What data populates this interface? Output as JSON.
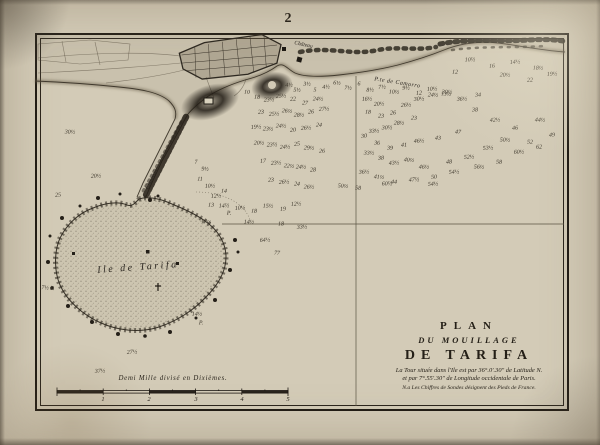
{
  "page": {
    "number": "2"
  },
  "map": {
    "island_label": "Ile de Tarifa",
    "point_label": "P.te de Camorro",
    "chateau_label": "Château",
    "causeway_label": "Chaussée",
    "title_block": {
      "line1": "PLAN",
      "line2": "DU MOUILLAGE",
      "line3": "DE TARIFA",
      "note1": "La Tour située dans l'Ile est par 36°.0′.30″ de Latitude N.",
      "note2": "et par 7°.55′.30″ de Longitude occidentale de Paris.",
      "note3": "N.a Les Chiffres de Sondes désignent des Pieds de France."
    },
    "scale": {
      "label": "Demi Mille divisé en Dixièmes.",
      "ticks": [
        "1",
        "2",
        "3",
        "4",
        "5"
      ]
    },
    "soundings": [
      {
        "x": 289,
        "y": 85,
        "v": "4½"
      },
      {
        "x": 297,
        "y": 90,
        "v": "5½"
      },
      {
        "x": 307,
        "y": 84,
        "v": "3½"
      },
      {
        "x": 315,
        "y": 90,
        "v": "5"
      },
      {
        "x": 326,
        "y": 87,
        "v": "4½"
      },
      {
        "x": 337,
        "y": 83,
        "v": "6½"
      },
      {
        "x": 348,
        "y": 88,
        "v": "7½"
      },
      {
        "x": 359,
        "y": 84,
        "v": "6"
      },
      {
        "x": 370,
        "y": 90,
        "v": "8½"
      },
      {
        "x": 382,
        "y": 87,
        "v": "7½"
      },
      {
        "x": 394,
        "y": 92,
        "v": "10½"
      },
      {
        "x": 406,
        "y": 88,
        "v": "9½"
      },
      {
        "x": 419,
        "y": 93,
        "v": "12"
      },
      {
        "x": 432,
        "y": 89,
        "v": "10½"
      },
      {
        "x": 446,
        "y": 94,
        "v": "13½"
      },
      {
        "x": 455,
        "y": 72,
        "v": "12"
      },
      {
        "x": 470,
        "y": 60,
        "v": "10½"
      },
      {
        "x": 492,
        "y": 66,
        "v": "16"
      },
      {
        "x": 515,
        "y": 62,
        "v": "14½"
      },
      {
        "x": 538,
        "y": 68,
        "v": "18½"
      },
      {
        "x": 505,
        "y": 75,
        "v": "20½"
      },
      {
        "x": 530,
        "y": 80,
        "v": "22"
      },
      {
        "x": 552,
        "y": 74,
        "v": "19½"
      },
      {
        "x": 247,
        "y": 92,
        "v": "10"
      },
      {
        "x": 257,
        "y": 97,
        "v": "18"
      },
      {
        "x": 269,
        "y": 100,
        "v": "23½"
      },
      {
        "x": 281,
        "y": 96,
        "v": "25½"
      },
      {
        "x": 293,
        "y": 99,
        "v": "22"
      },
      {
        "x": 305,
        "y": 103,
        "v": "27"
      },
      {
        "x": 318,
        "y": 99,
        "v": "24½"
      },
      {
        "x": 261,
        "y": 112,
        "v": "23"
      },
      {
        "x": 274,
        "y": 114,
        "v": "25½"
      },
      {
        "x": 287,
        "y": 111,
        "v": "26½"
      },
      {
        "x": 299,
        "y": 115,
        "v": "28½"
      },
      {
        "x": 311,
        "y": 112,
        "v": "26"
      },
      {
        "x": 324,
        "y": 109,
        "v": "27½"
      },
      {
        "x": 256,
        "y": 127,
        "v": "19½"
      },
      {
        "x": 268,
        "y": 129,
        "v": "23½"
      },
      {
        "x": 281,
        "y": 126,
        "v": "24½"
      },
      {
        "x": 293,
        "y": 130,
        "v": "20"
      },
      {
        "x": 306,
        "y": 128,
        "v": "26½"
      },
      {
        "x": 319,
        "y": 125,
        "v": "24"
      },
      {
        "x": 259,
        "y": 143,
        "v": "20½"
      },
      {
        "x": 272,
        "y": 145,
        "v": "23½"
      },
      {
        "x": 285,
        "y": 147,
        "v": "24½"
      },
      {
        "x": 297,
        "y": 144,
        "v": "25"
      },
      {
        "x": 309,
        "y": 148,
        "v": "29½"
      },
      {
        "x": 322,
        "y": 151,
        "v": "26"
      },
      {
        "x": 263,
        "y": 161,
        "v": "17"
      },
      {
        "x": 276,
        "y": 163,
        "v": "23½"
      },
      {
        "x": 289,
        "y": 166,
        "v": "22½"
      },
      {
        "x": 301,
        "y": 167,
        "v": "24½"
      },
      {
        "x": 313,
        "y": 170,
        "v": "28"
      },
      {
        "x": 271,
        "y": 180,
        "v": "23"
      },
      {
        "x": 284,
        "y": 182,
        "v": "26½"
      },
      {
        "x": 297,
        "y": 184,
        "v": "24"
      },
      {
        "x": 309,
        "y": 187,
        "v": "26½"
      },
      {
        "x": 367,
        "y": 99,
        "v": "16½"
      },
      {
        "x": 379,
        "y": 104,
        "v": "20½"
      },
      {
        "x": 368,
        "y": 112,
        "v": "18"
      },
      {
        "x": 381,
        "y": 116,
        "v": "23"
      },
      {
        "x": 393,
        "y": 113,
        "v": "26"
      },
      {
        "x": 406,
        "y": 105,
        "v": "26½"
      },
      {
        "x": 419,
        "y": 99,
        "v": "30½"
      },
      {
        "x": 433,
        "y": 95,
        "v": "24½"
      },
      {
        "x": 447,
        "y": 92,
        "v": "30½"
      },
      {
        "x": 462,
        "y": 99,
        "v": "36½"
      },
      {
        "x": 478,
        "y": 95,
        "v": "34"
      },
      {
        "x": 414,
        "y": 118,
        "v": "23"
      },
      {
        "x": 399,
        "y": 123,
        "v": "28½"
      },
      {
        "x": 387,
        "y": 128,
        "v": "30½"
      },
      {
        "x": 374,
        "y": 131,
        "v": "33½"
      },
      {
        "x": 364,
        "y": 136,
        "v": "30"
      },
      {
        "x": 377,
        "y": 143,
        "v": "36"
      },
      {
        "x": 390,
        "y": 148,
        "v": "39"
      },
      {
        "x": 404,
        "y": 145,
        "v": "41"
      },
      {
        "x": 419,
        "y": 141,
        "v": "46½"
      },
      {
        "x": 438,
        "y": 138,
        "v": "43"
      },
      {
        "x": 458,
        "y": 132,
        "v": "47"
      },
      {
        "x": 475,
        "y": 110,
        "v": "38"
      },
      {
        "x": 495,
        "y": 120,
        "v": "42½"
      },
      {
        "x": 515,
        "y": 128,
        "v": "46"
      },
      {
        "x": 540,
        "y": 120,
        "v": "44½"
      },
      {
        "x": 369,
        "y": 153,
        "v": "33½"
      },
      {
        "x": 381,
        "y": 158,
        "v": "38"
      },
      {
        "x": 394,
        "y": 163,
        "v": "43½"
      },
      {
        "x": 409,
        "y": 160,
        "v": "40½"
      },
      {
        "x": 424,
        "y": 167,
        "v": "46½"
      },
      {
        "x": 449,
        "y": 162,
        "v": "48"
      },
      {
        "x": 469,
        "y": 157,
        "v": "52½"
      },
      {
        "x": 488,
        "y": 148,
        "v": "53½"
      },
      {
        "x": 505,
        "y": 140,
        "v": "50½"
      },
      {
        "x": 530,
        "y": 142,
        "v": "52"
      },
      {
        "x": 552,
        "y": 135,
        "v": "49"
      },
      {
        "x": 364,
        "y": 172,
        "v": "36½"
      },
      {
        "x": 379,
        "y": 177,
        "v": "41½"
      },
      {
        "x": 394,
        "y": 182,
        "v": "44"
      },
      {
        "x": 414,
        "y": 180,
        "v": "47½"
      },
      {
        "x": 434,
        "y": 177,
        "v": "50"
      },
      {
        "x": 454,
        "y": 172,
        "v": "54½"
      },
      {
        "x": 479,
        "y": 167,
        "v": "56½"
      },
      {
        "x": 499,
        "y": 162,
        "v": "58"
      },
      {
        "x": 519,
        "y": 152,
        "v": "60½"
      },
      {
        "x": 539,
        "y": 147,
        "v": "62"
      },
      {
        "x": 343,
        "y": 186,
        "v": "50½"
      },
      {
        "x": 358,
        "y": 188,
        "v": "58"
      },
      {
        "x": 387,
        "y": 184,
        "v": "60½"
      },
      {
        "x": 433,
        "y": 184,
        "v": "54½"
      },
      {
        "x": 196,
        "y": 162,
        "v": "7"
      },
      {
        "x": 205,
        "y": 169,
        "v": "9½"
      },
      {
        "x": 200,
        "y": 179,
        "v": "11"
      },
      {
        "x": 210,
        "y": 186,
        "v": "10½"
      },
      {
        "x": 216,
        "y": 196,
        "v": "12½"
      },
      {
        "x": 224,
        "y": 191,
        "v": "14"
      },
      {
        "x": 211,
        "y": 205,
        "v": "13"
      },
      {
        "x": 224,
        "y": 206,
        "v": "14½"
      },
      {
        "x": 229,
        "y": 213,
        "v": "P."
      },
      {
        "x": 240,
        "y": 208,
        "v": "10½"
      },
      {
        "x": 254,
        "y": 211,
        "v": "18"
      },
      {
        "x": 268,
        "y": 206,
        "v": "15½"
      },
      {
        "x": 283,
        "y": 209,
        "v": "19"
      },
      {
        "x": 296,
        "y": 204,
        "v": "12½"
      },
      {
        "x": 206,
        "y": 222,
        "v": "17½"
      },
      {
        "x": 249,
        "y": 222,
        "v": "14½"
      },
      {
        "x": 281,
        "y": 224,
        "v": "18"
      },
      {
        "x": 302,
        "y": 227,
        "v": "33½"
      },
      {
        "x": 265,
        "y": 240,
        "v": "64½"
      },
      {
        "x": 277,
        "y": 253,
        "v": "77"
      },
      {
        "x": 70,
        "y": 132,
        "v": "30½"
      },
      {
        "x": 96,
        "y": 176,
        "v": "20½"
      },
      {
        "x": 58,
        "y": 195,
        "v": "25"
      },
      {
        "x": 48,
        "y": 288,
        "v": "7½ P."
      },
      {
        "x": 197,
        "y": 314,
        "v": "14½"
      },
      {
        "x": 201,
        "y": 323,
        "v": "P."
      },
      {
        "x": 100,
        "y": 371,
        "v": "37½"
      },
      {
        "x": 132,
        "y": 352,
        "v": "27½"
      }
    ]
  }
}
